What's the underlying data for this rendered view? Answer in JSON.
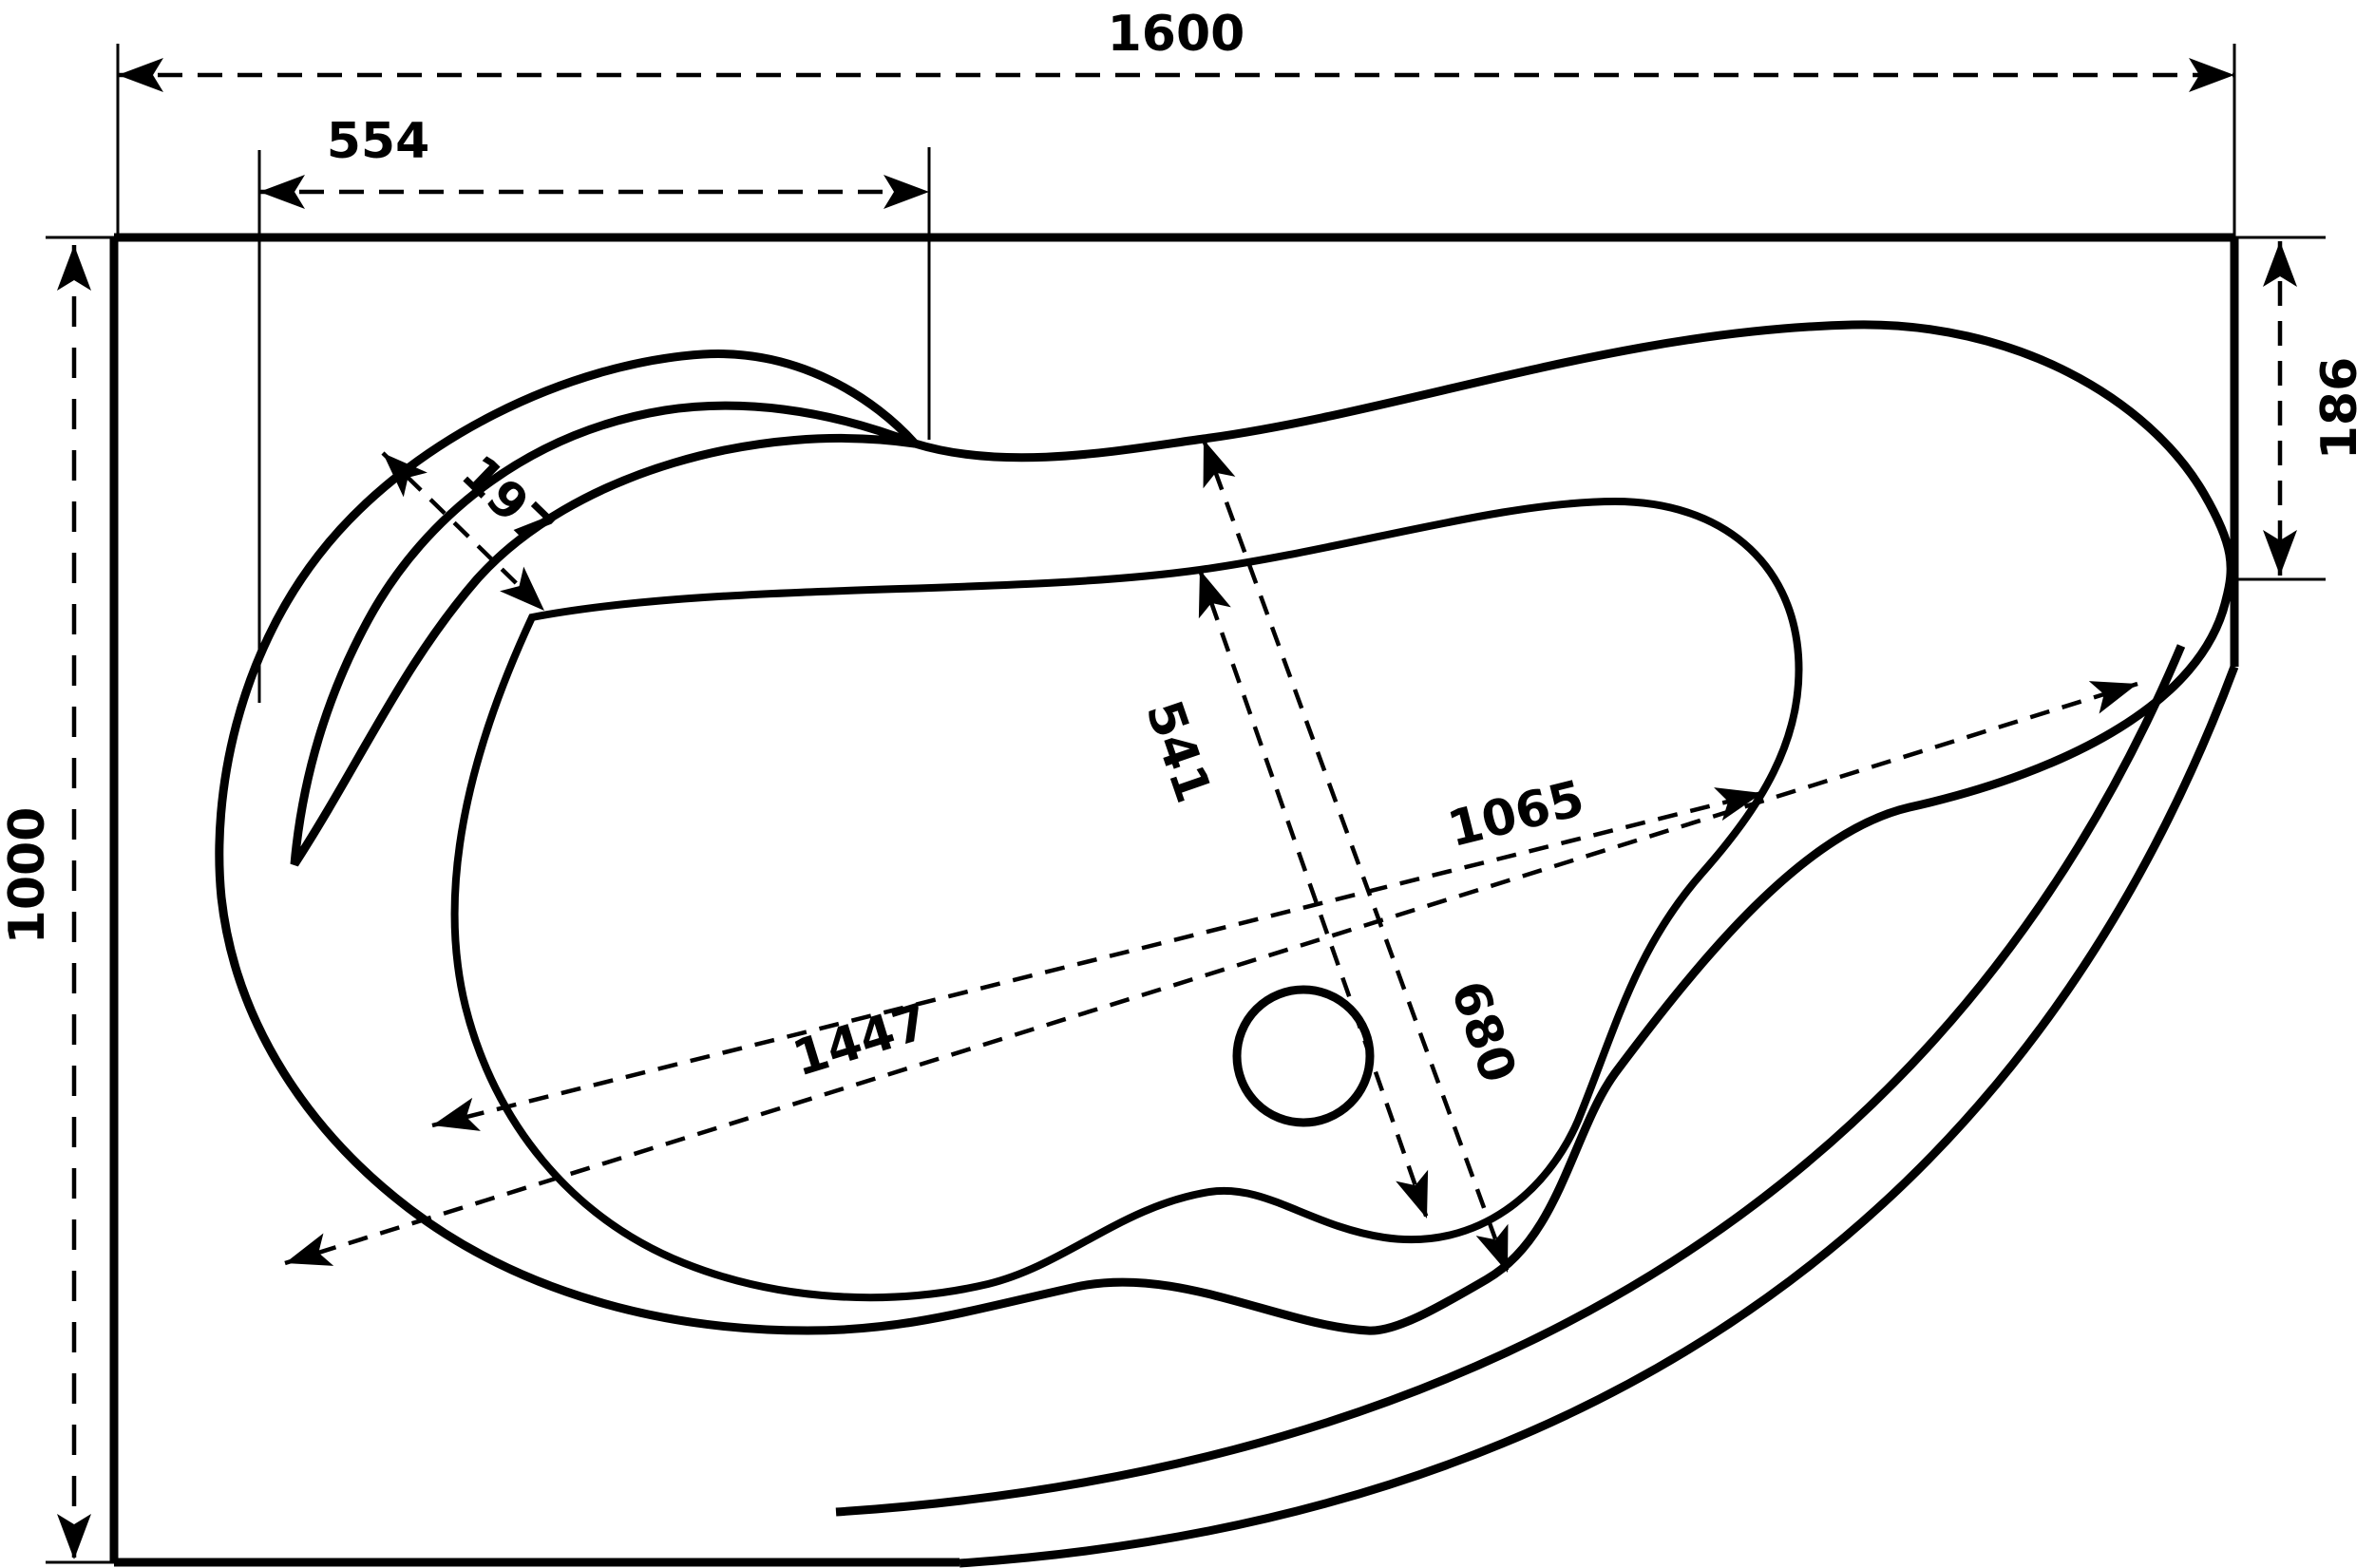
{
  "diagram": {
    "type": "technical-drawing",
    "subject": "corner bathtub top view with dimensions",
    "units": "mm",
    "colors": {
      "line": "#000000",
      "background": "#ffffff"
    },
    "dimensions": {
      "overall_width": "1600",
      "overall_depth": "1000",
      "headrest_width": "554",
      "rim_shelf_width": "197",
      "right_corner_height": "186",
      "basin_width": "541",
      "basin_outer_width": "680",
      "basin_length": "1065",
      "overall_diagonal": "1447"
    }
  }
}
